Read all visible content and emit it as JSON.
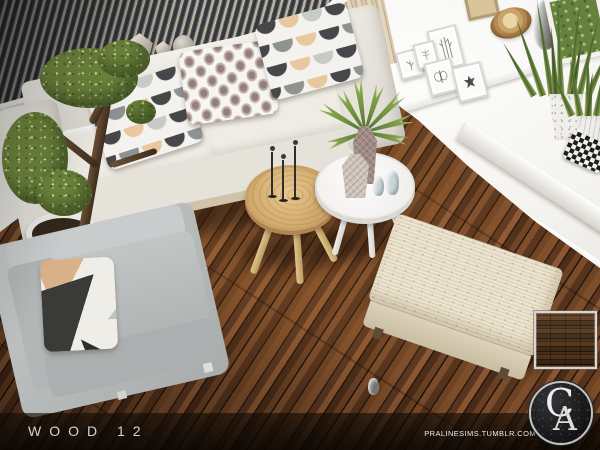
{
  "footer": {
    "title": "WOOD 12",
    "watermark": "PRALINESIMS.TUMBLR.COM"
  },
  "logo": {
    "letter_c": "C",
    "letter_a": "A"
  },
  "colors": {
    "floor_brown_dark": "#2a180c",
    "floor_brown_mid": "#6e4323",
    "floor_brown_light": "#8a5733",
    "wall_white": "#f2f1ed",
    "blinds_gray": "#34373c",
    "sofa_cream": "#ece9e2",
    "armchair_gray": "#b9bcbc",
    "bench_beige": "#ece4d0",
    "coffee_table_wood": "#cda265",
    "coffee_table_white": "#fbfbf9",
    "plant_green": "#71883f",
    "pillow_peach": "#e9c79f",
    "pillow_charcoal": "#474649",
    "footer_overlay": "rgba(10,6,3,0.8)",
    "footer_text": "#d4d4d2"
  },
  "scene": {
    "description": "Top-down living room render: cream sofa with patterned pillows, gray armchair, bonsai tree, round wooden and white coffee tables, woven bench, picture frames and snake plants on white shelving, dark wood plank floor",
    "swatch": "dark wood floor texture swatch"
  }
}
